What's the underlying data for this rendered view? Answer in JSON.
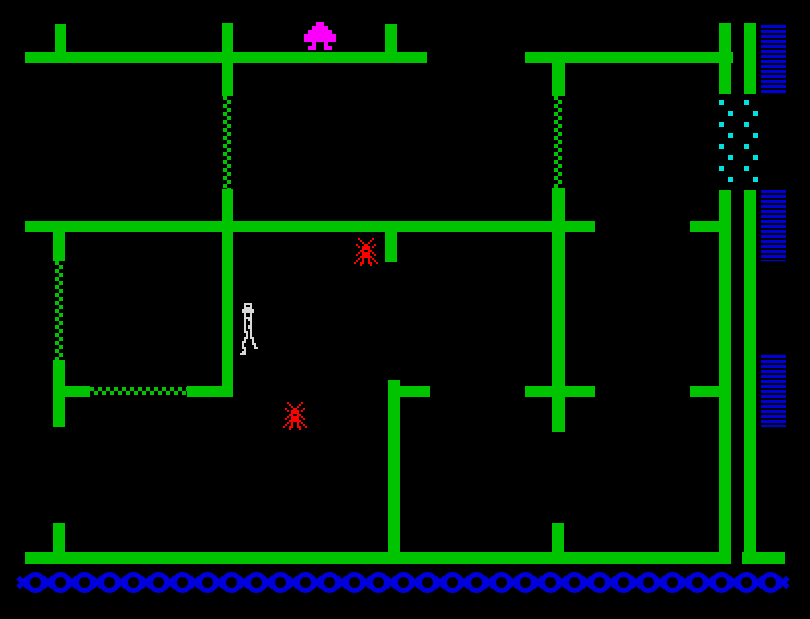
{
  "meta": {
    "app": "zx-spectrum-maze-game-screen",
    "visible_text": []
  },
  "palette": {
    "background": "#000000",
    "green": "#00C400",
    "blue": "#0000DC",
    "magenta": "#FA00FA",
    "red": "#FF0000",
    "cyan": "#00E0E0",
    "white": "#D8D8D8"
  },
  "screen": {
    "width": 810,
    "height": 619
  },
  "level": {
    "walls": [
      [
        25,
        52,
        402,
        11,
        "platform-top-left"
      ],
      [
        525,
        52,
        208,
        11,
        "platform-top-right"
      ],
      [
        25,
        221,
        570,
        11,
        "platform-middle"
      ],
      [
        690,
        221,
        41,
        11,
        "arm-middle-right"
      ],
      [
        525,
        386,
        70,
        11,
        "cross-arm-center"
      ],
      [
        400,
        386,
        30,
        11,
        "stub-arm-center-left"
      ],
      [
        65,
        386,
        25,
        11,
        "arm-left-post"
      ],
      [
        187,
        386,
        45,
        11,
        "arm-left-corner"
      ],
      [
        690,
        386,
        41,
        11,
        "arm-lower-right"
      ],
      [
        25,
        552,
        703,
        12,
        "platform-bottom"
      ],
      [
        742,
        552,
        43,
        12,
        "platform-bottom-right-foot"
      ],
      [
        55,
        24,
        11,
        28,
        "post-top-1"
      ],
      [
        222,
        23,
        11,
        29,
        "post-top-2"
      ],
      [
        385,
        24,
        12,
        28,
        "post-top-3"
      ],
      [
        222,
        63,
        11,
        33,
        "bar-upper-2"
      ],
      [
        222,
        189,
        11,
        208,
        "bar-mid-2"
      ],
      [
        552,
        63,
        13,
        33,
        "bar-upper-5"
      ],
      [
        552,
        188,
        13,
        33,
        "bar-mid-5"
      ],
      [
        385,
        232,
        12,
        30,
        "stub-below-middle"
      ],
      [
        552,
        232,
        13,
        200,
        "bar-long-center"
      ],
      [
        388,
        380,
        12,
        172,
        "bar-lower-center"
      ],
      [
        552,
        523,
        12,
        29,
        "stub-bottom-center"
      ],
      [
        53,
        232,
        12,
        29,
        "bar-left-upper"
      ],
      [
        53,
        360,
        12,
        67,
        "bar-left-lower"
      ],
      [
        53,
        523,
        12,
        29,
        "stub-bottom-left"
      ],
      [
        719,
        23,
        12,
        71,
        "wall-right-inner-top"
      ],
      [
        744,
        23,
        12,
        71,
        "wall-right-outer-top"
      ],
      [
        719,
        190,
        12,
        374,
        "wall-right-inner-main"
      ],
      [
        744,
        190,
        12,
        374,
        "wall-right-outer-main"
      ]
    ],
    "ropes": [
      {
        "x": 223,
        "y": 96,
        "len": 93,
        "dir": "v"
      },
      {
        "x": 554,
        "y": 96,
        "len": 92,
        "dir": "v"
      },
      {
        "x": 55,
        "y": 261,
        "len": 99,
        "dir": "v"
      },
      {
        "x": 90,
        "y": 387,
        "len": 97,
        "dir": "h"
      }
    ],
    "gates": [
      {
        "x": 719,
        "y": 100,
        "count": 8,
        "spacing": 11,
        "amplitude": 9
      },
      {
        "x": 744,
        "y": 100,
        "count": 8,
        "spacing": 11,
        "amplitude": 9
      }
    ],
    "ladders": [
      {
        "x": 761,
        "y": 25,
        "w": 25,
        "h": 68
      },
      {
        "x": 761,
        "y": 190,
        "w": 25,
        "h": 71
      },
      {
        "x": 761,
        "y": 355,
        "w": 25,
        "h": 72
      }
    ],
    "chain": {
      "x": 25,
      "y": 572,
      "count": 31,
      "pitch": 24.5
    }
  },
  "sprites": {
    "tree": {
      "cell": 4,
      "color_key": "magenta",
      "map": [
        "...##...",
        "..####..",
        ".######.",
        "########",
        "########",
        "..#..#..",
        ".##..##."
      ]
    },
    "spider": {
      "cell": 2,
      "color_key": "red",
      "map": [
        "..#......#...",
        "...#....#....",
        "....#..#.....",
        ".#...##...#..",
        "..#.####.#...",
        "....####.....",
        "...##..##....",
        "..#.####.#...",
        ".#..####..#..",
        "...######....",
        "..#.#..#.#...",
        ".#..#..#..#..",
        "#..##..##..#.",
        "...#....#...."
      ]
    },
    "player": {
      "cell": 2,
      "color_key": "white",
      "map": [
        "..####...",
        "..#..#...",
        "..####...",
        ".######..",
        ".######..",
        "..#..#...",
        "..#..#...",
        "..####...",
        "..#.##...",
        "..#..#...",
        "..#..#...",
        "..#.##...",
        "..#.##...",
        "..#..#...",
        "..##.#...",
        "...#.#...",
        "...#.#...",
        "..##.##..",
        "..#...#..",
        ".##...#..",
        ".#....##.",
        ".#.....#.",
        ".##....##",
        "..#......",
        ".##......",
        "###......"
      ]
    }
  },
  "actors": [
    {
      "sprite": "tree",
      "x": 304,
      "y": 22,
      "name": "tree-sprite"
    },
    {
      "sprite": "spider",
      "x": 354,
      "y": 238,
      "name": "spider-sprite"
    },
    {
      "sprite": "spider",
      "x": 283,
      "y": 402,
      "name": "spider-sprite"
    },
    {
      "sprite": "player",
      "x": 240,
      "y": 303,
      "name": "player-sprite"
    }
  ]
}
